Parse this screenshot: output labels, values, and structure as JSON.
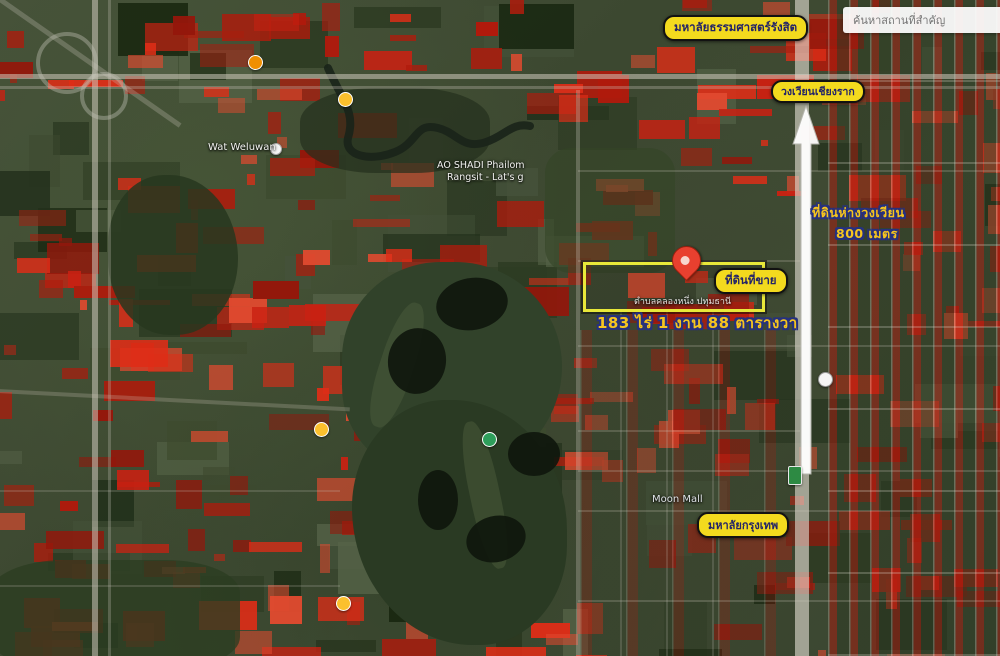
{
  "search": {
    "placeholder": "ค้นหาสถานที่สำคัญ"
  },
  "annotations": {
    "university_top": "มหาลัยธรรมศาสตร์รังสิต",
    "roundabout": "วงเวียนเชียงราก",
    "distance_line1": "ที่ดินห่างวงเวียน",
    "distance_line2": "800 เมตร",
    "for_sale": "ที่ดินที่ขาย",
    "area": "183 ไร่ 1 งาน 88 ตารางวา",
    "university_bottom": "มหาลัยกรุงเทพ"
  },
  "place_labels": {
    "wat": "Wat Weluwan",
    "ao_shadi_line1": "AO SHADI Phailom",
    "ao_shadi_line2": "Rangsit - Lat's g",
    "subdistrict": "ตำบลคลองหนึ่ง ปทุมธานี",
    "mall": "Moon Mall"
  },
  "colors": {
    "annotation_bg": "#f3da1e",
    "annotation_text": "#232368",
    "outline_text_fill": "#f6c51f",
    "outline_text_stroke": "#26317f",
    "plot_border": "#e8e83a",
    "pin": "#e8402f",
    "red_patch": "#c92112"
  }
}
